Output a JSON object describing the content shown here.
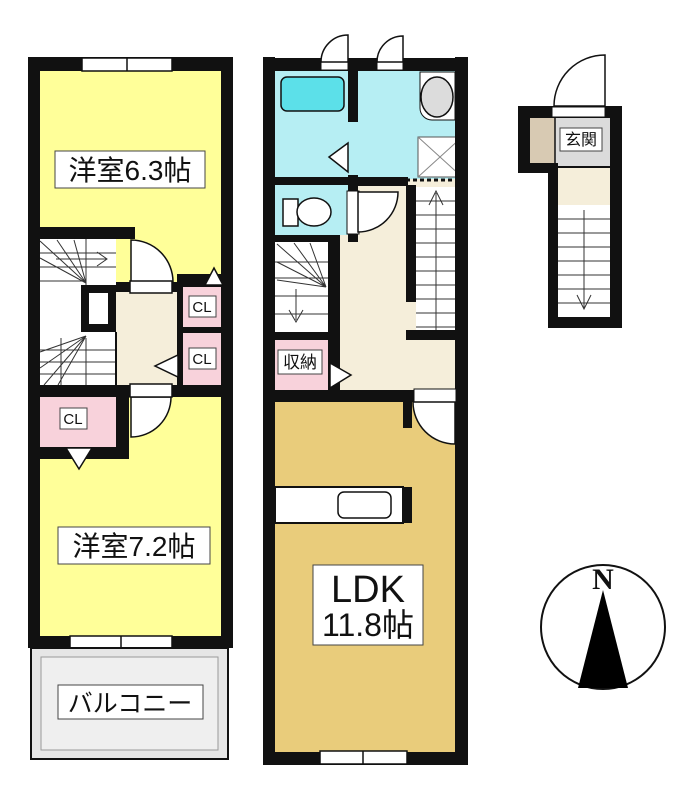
{
  "title": "floor-plan",
  "labels": {
    "room_6_3": "洋室6.3帖",
    "room_7_2": "洋室7.2帖",
    "balcony": "バルコニー",
    "ldk_line1": "LDK",
    "ldk_line2": "11.8帖",
    "closet1": "CL",
    "closet2": "CL",
    "closet3": "CL",
    "storage": "収納",
    "entrance": "玄関",
    "compass_north": "N"
  },
  "colors": {
    "wall": "#111111",
    "yellow": "#FFFF99",
    "tan": "#E9CC7B",
    "cream": "#F5EEDA",
    "pink": "#F8D2DB",
    "cyan": "#B6EEF3",
    "tub": "#5CE0E9",
    "balcony": "#E6E6E6",
    "balcony_inner": "#EFEFEF",
    "genkan": "#DBDBDB",
    "porch": "#D8CAB3",
    "fixture": "#DCDCDC"
  }
}
